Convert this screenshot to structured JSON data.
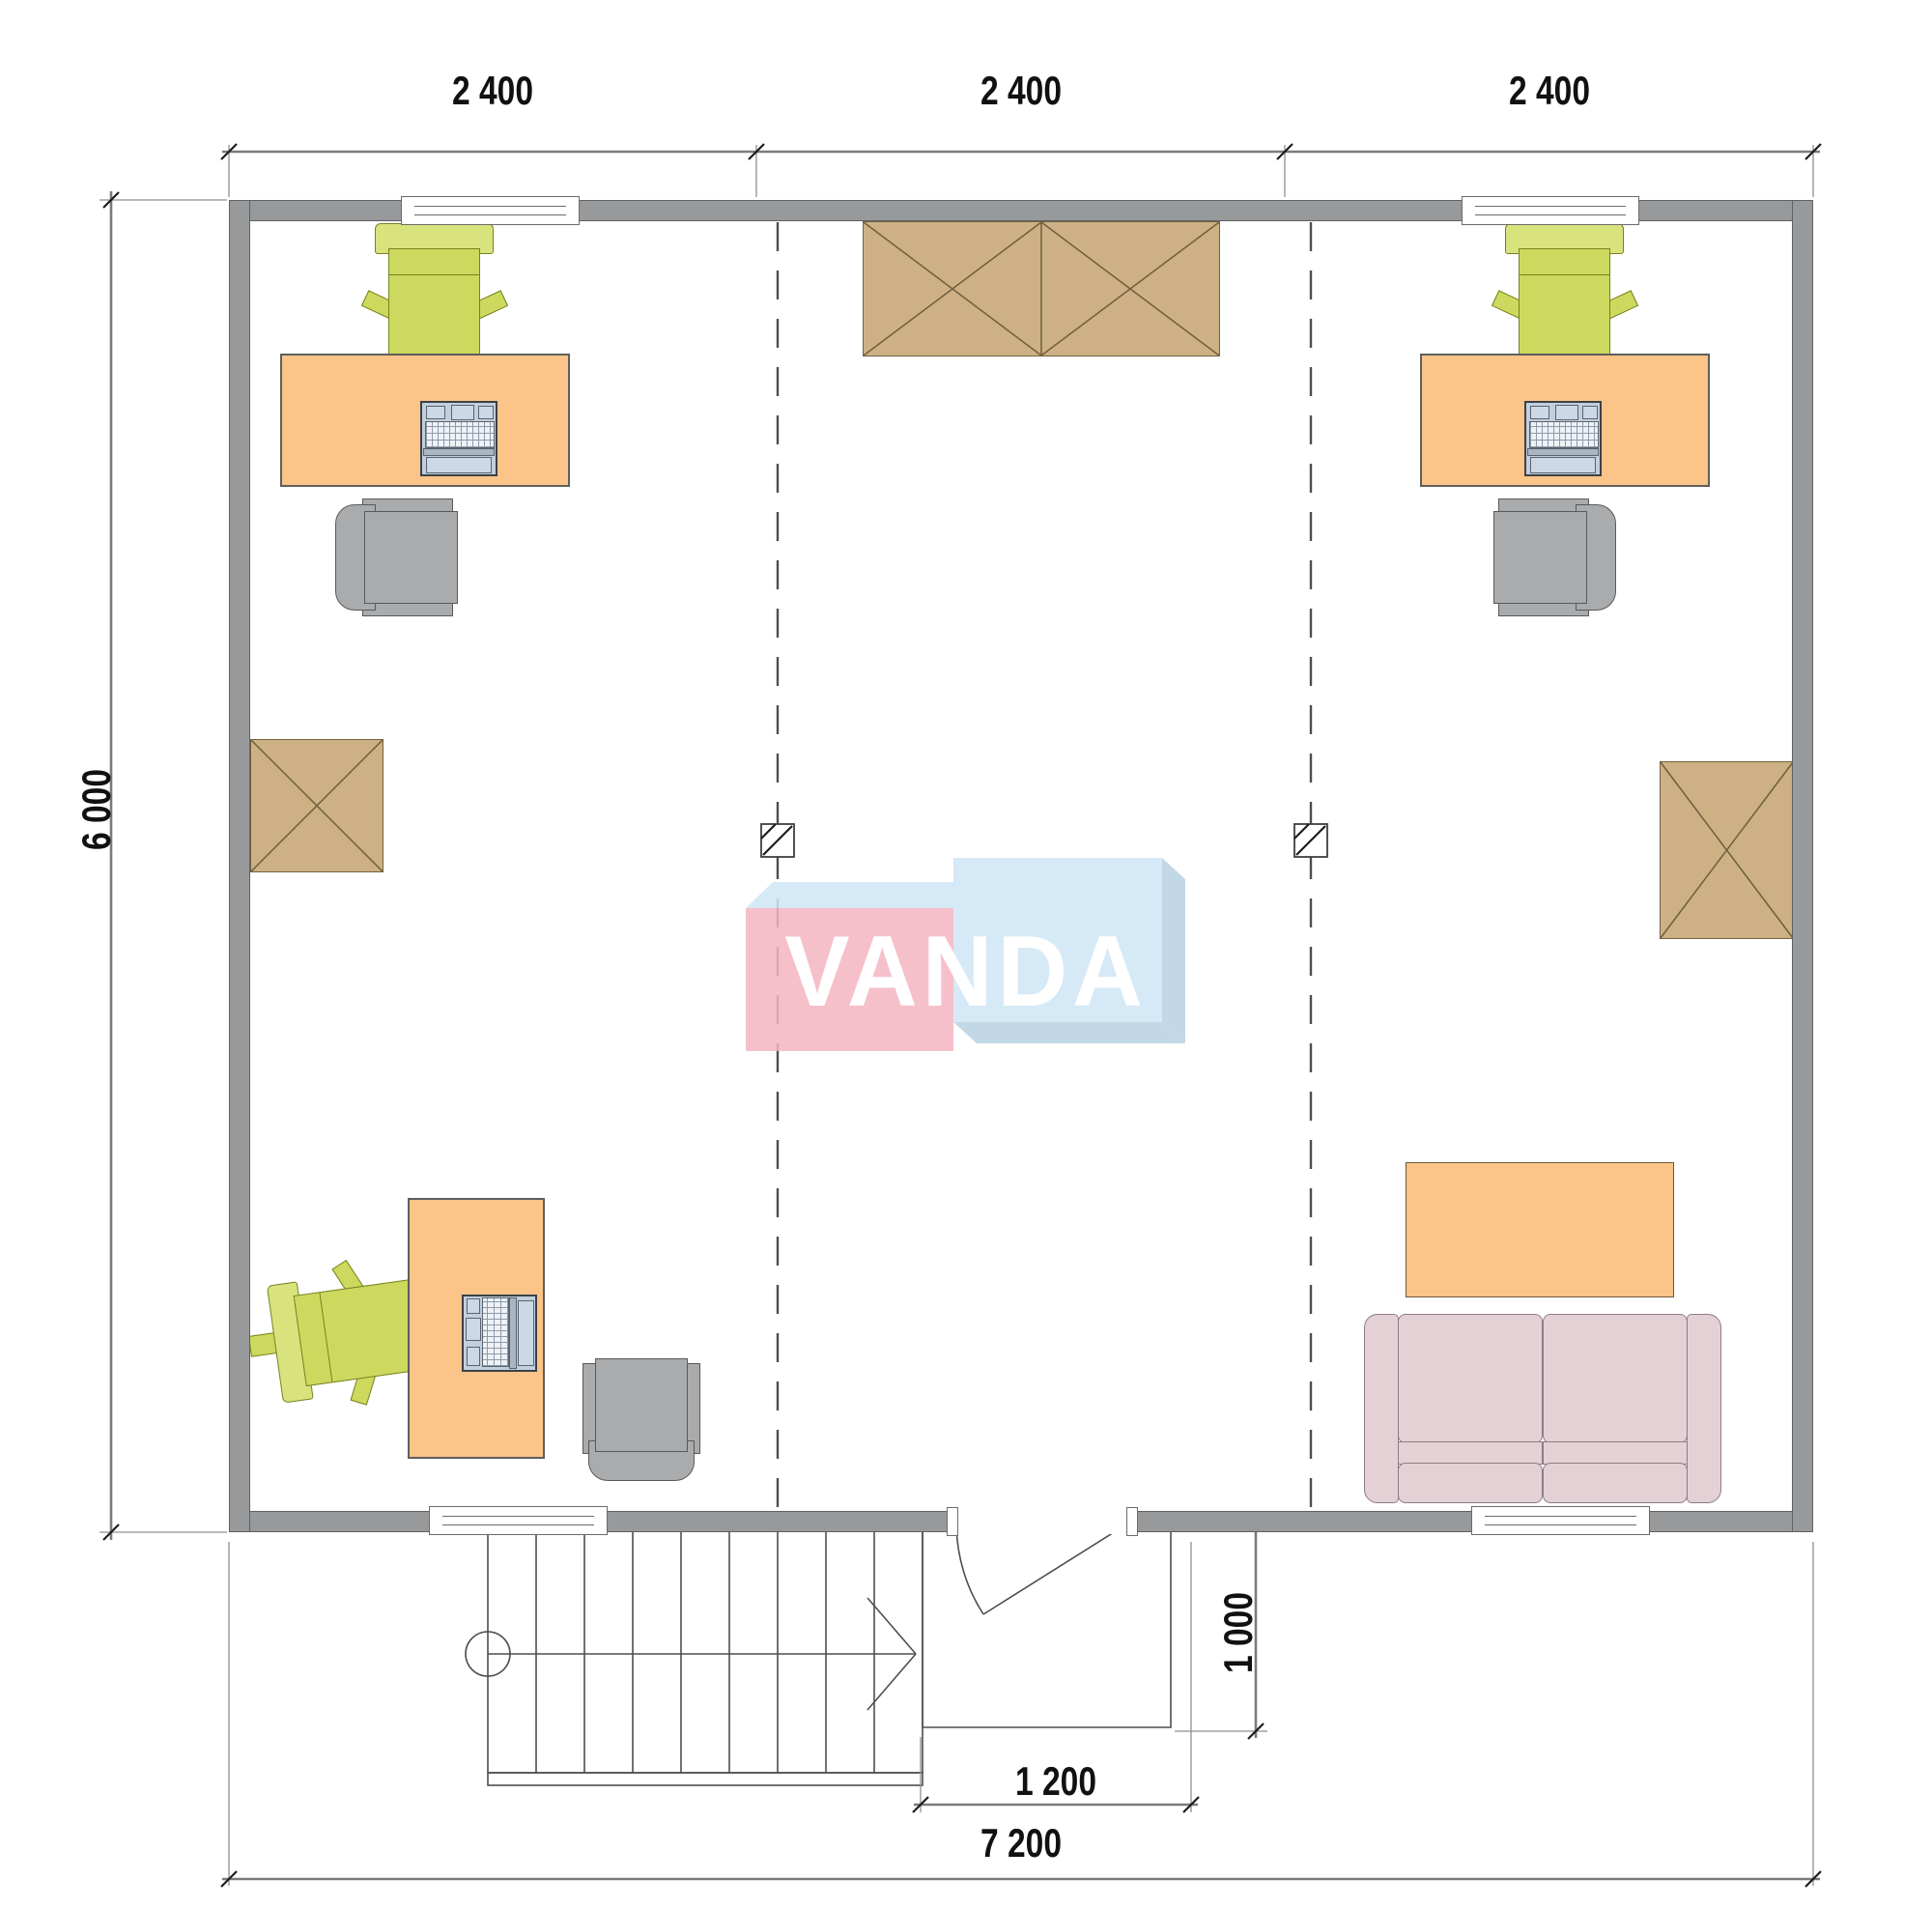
{
  "watermark": {
    "text": "VANDA"
  },
  "dimensions": {
    "top": [
      "2 400",
      "2 400",
      "2 400"
    ],
    "left": "6 000",
    "bottom_total": "7 200",
    "entry_width": "1 200",
    "porch_depth": "1 000"
  },
  "colors": {
    "wall": "#97999b",
    "wall_line": "#5f6163",
    "desk": "#fbc488",
    "chair_green": "#ccd95e",
    "chair_green_light": "#d9e37e",
    "chair_green_line": "#76821f",
    "chair_gray": "#a9abad",
    "chair_gray_line": "#58595b",
    "cabinet": "#cdb185",
    "cabinet_line": "#72623f",
    "sofa": "#e3d1d6",
    "sofa_line": "#8f7c82",
    "laptop_body": "#c2cfdd",
    "laptop_screen": "#ccd8e5",
    "laptop_line": "#3c4148",
    "logo_pink": "#f5b6c1",
    "logo_blue": "#cfe6f5",
    "logo_blue_dark": "#b9d2e2",
    "logo_text": "#ffffff",
    "dim_line": "#7b7b7b",
    "dim_text": "#111111",
    "draw_line": "#4e4e4e"
  }
}
